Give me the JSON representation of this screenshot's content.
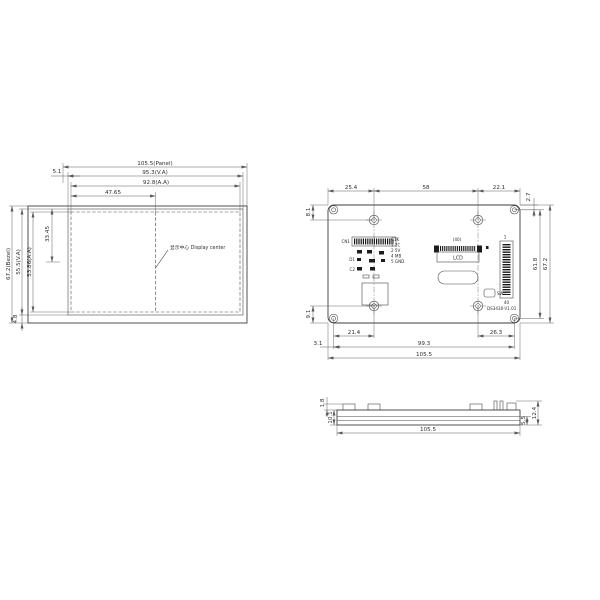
{
  "front_view": {
    "dim_panel_width": "105.5(Panel)",
    "dim_va_width": "95.3(V.A)",
    "dim_aa_width": "92.8(A.A)",
    "dim_half_width": "47.65",
    "dim_left_offset": "5.1",
    "dim_bezel_height": "67.2(Bezel)",
    "dim_va_height": "55.5(V.A)",
    "dim_aa_height": "53.86(A.A)",
    "dim_center_vertical": "33.45",
    "dim_bottom_offset": "4.8",
    "callout_display_center": "显示中心 Display center"
  },
  "back_view": {
    "dim_top_left": "25.4",
    "dim_top_mid": "58",
    "dim_top_right": "22.1",
    "dim_corner_top": "2.7",
    "dim_left_top": "8.1",
    "dim_left_bottom": "9.1",
    "dim_right_inner": "61.8",
    "dim_right_outer": "67.2",
    "dim_bottom_hole_left": "21.4",
    "dim_bottom_hole_right": "26.3",
    "dim_bottom_holes_span": "99.3",
    "dim_bottom_total": "105.5",
    "dim_corner_left": "3.1",
    "board_label": "DS3430-V1.01",
    "lcd_connector": {
      "label": "LCD",
      "pin_count": "(40)"
    },
    "header": {
      "pin_first": "1",
      "pin_last": "40"
    },
    "switch_label": "SW1",
    "component_refs": {
      "cn": "CN1",
      "d": "D1",
      "c": "C2"
    },
    "component_legend": [
      "C1K",
      "1 2C",
      "2 5V",
      "4 MB",
      "5 GND"
    ]
  },
  "side_view": {
    "dim_bump_height": "1.8",
    "dim_body_height": "10.1",
    "dim_right_inner": "5.5",
    "dim_right_outer": "12.4",
    "dim_total_width": "105.5"
  }
}
